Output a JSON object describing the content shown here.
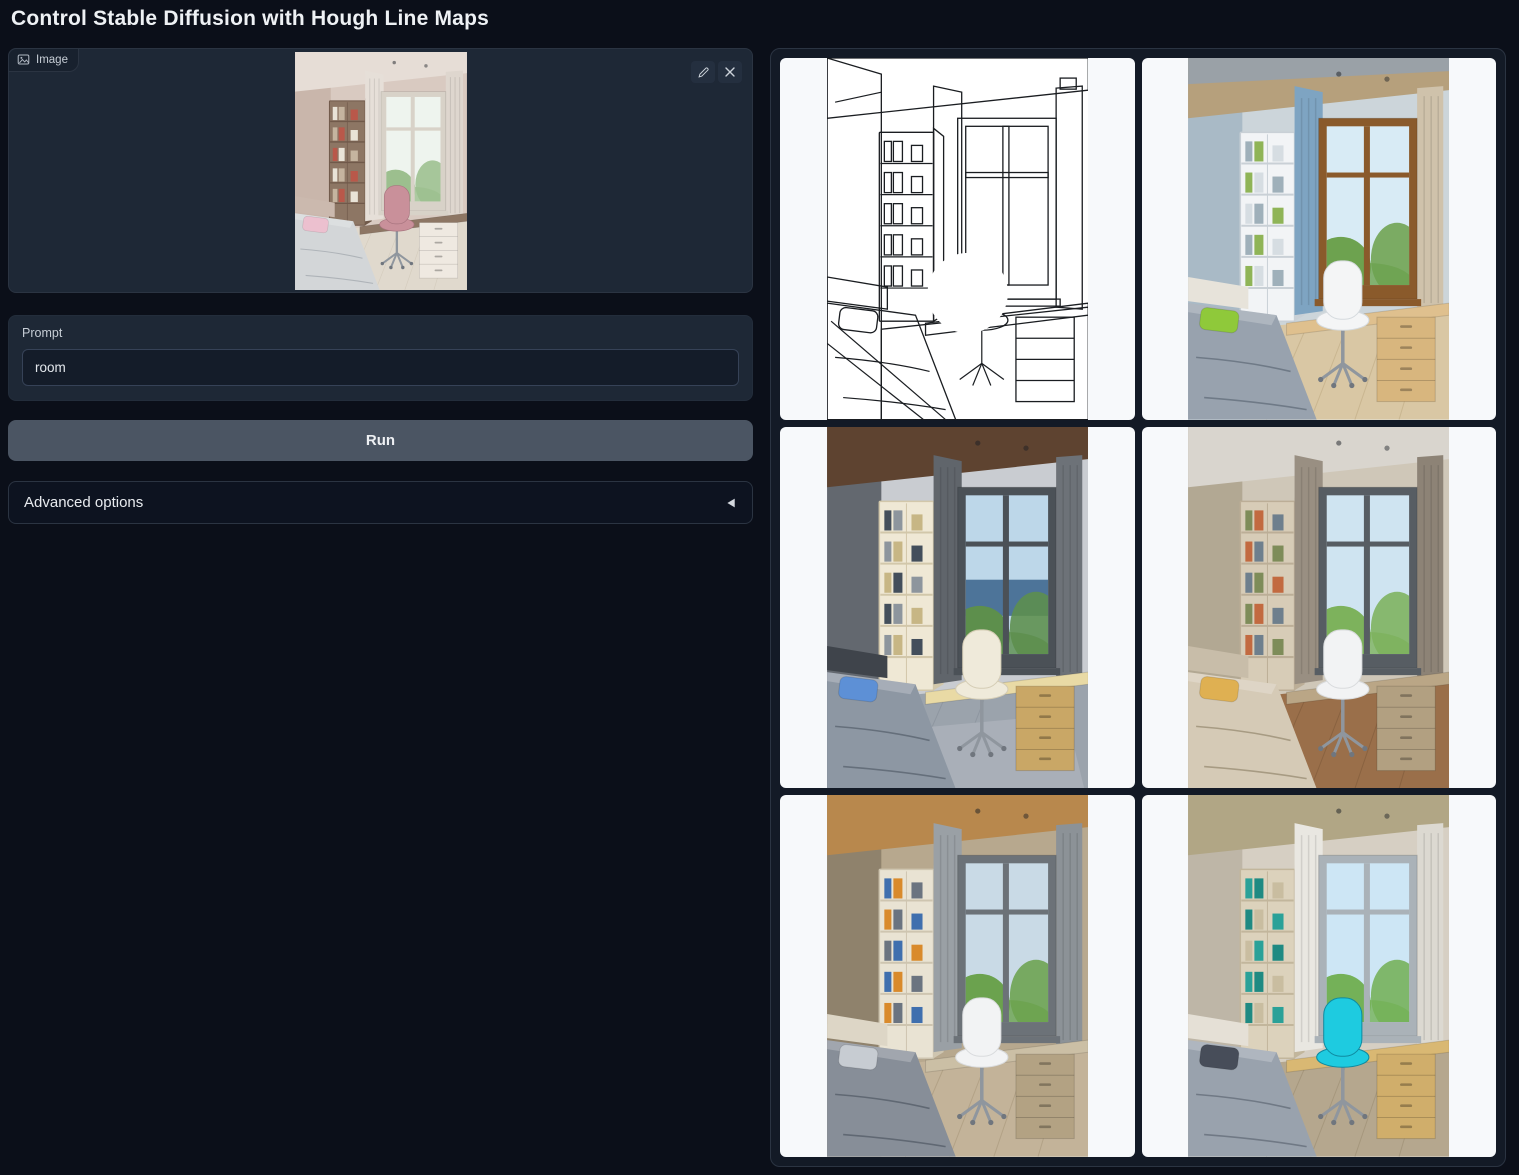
{
  "app": {
    "title": "Control Stable Diffusion with Hough Line Maps"
  },
  "theme": {
    "page_bg": "#0b0f19",
    "block_bg": "#1e2836",
    "block_border": "#2b3442",
    "input_bg": "#141c29",
    "input_border": "#364257",
    "button_bg": "#4b5563",
    "button_text": "#eef0f3",
    "accordion_bg": "#0d1320",
    "gallery_bg": "#131a26",
    "card_bg": "#f7f9fb",
    "text": "#eef1f4",
    "muted_text": "#c6cdd5"
  },
  "image_input": {
    "label": "Image",
    "image": {
      "name": "uploaded-room-photo",
      "type": "room",
      "palette": {
        "wall": "#d9cac1",
        "wallSide": "#c9b6ab",
        "ceiling": "#e6ddd6",
        "band": null,
        "curtainL": "#e6dfd8",
        "curtainR": "#ded6ce",
        "shelf": "#8d7664",
        "shelfLine": "#70594a",
        "books": [
          "#e9e3d7",
          "#c5b49f",
          "#b9584a"
        ],
        "winFrame": "#d8d2c8",
        "sky": "#eef4ee",
        "sea": null,
        "tree": "#9cbf8e",
        "desk": "#8d7664",
        "drawer": "#efe9e1",
        "chair": "#c9909a",
        "chairEdge": "#a8747f",
        "bed": "#d3d6d8",
        "bedLine": "#aeb3b8",
        "pillow": "#ecc0cf",
        "headboard": "#cbb9ae",
        "floor": "#e0d9cd",
        "floorLine": "#cdc4b4",
        "rug": null
      }
    }
  },
  "prompt": {
    "label": "Prompt",
    "value": "room"
  },
  "actions": {
    "run_label": "Run"
  },
  "advanced": {
    "label": "Advanced options"
  },
  "gallery": {
    "items": [
      {
        "name": "hough-line-map",
        "type": "lineart",
        "palette": null
      },
      {
        "name": "generated-room-1",
        "type": "room",
        "palette": {
          "wall": "#ccd5da",
          "wallSide": "#a9bac6",
          "ceiling": "#b6a07c",
          "band": "#9aa1a7",
          "curtainL": "#7ea4c2",
          "curtainR": "#cfc2ab",
          "shelf": "#f2f4f6",
          "shelfLine": "#c9d0d6",
          "books": [
            "#9fb0ba",
            "#8fb457",
            "#d6dde2"
          ],
          "winFrame": "#8a5a2b",
          "sky": "#d8ebf5",
          "sea": null,
          "tree": "#6da24f",
          "desk": "#dfc08e",
          "drawer": "#d8b67e",
          "chair": "#f4f5f6",
          "chairEdge": "#d5dade",
          "bed": "#98a2ae",
          "bedLine": "#6f7a87",
          "pillow": "#8fc93a",
          "headboard": "#e7e3da",
          "floor": "#d9c7a4",
          "floorLine": "#c0ab84",
          "rug": null
        }
      },
      {
        "name": "generated-room-2",
        "type": "room",
        "palette": {
          "wall": "#c9ccd1",
          "wallSide": "#63686f",
          "ceiling": "#5e4330",
          "band": null,
          "curtainL": "#60656b",
          "curtainR": "#6d7278",
          "shelf": "#efe8d5",
          "shelfLine": "#d2c7aa",
          "books": [
            "#434e5b",
            "#8d959d",
            "#c7b685"
          ],
          "winFrame": "#4b5157",
          "sky": "#bdd7e9",
          "sea": "#4d7499",
          "tree": "#5d8f4c",
          "desk": "#e9daa5",
          "drawer": "#c9a766",
          "chair": "#efeada",
          "chairEdge": "#d5cdb5",
          "bed": "#8d97a3",
          "bedLine": "#656f7b",
          "pillow": "#5d90d6",
          "headboard": "#3f444b",
          "floor": "#9ba3ac",
          "floorLine": "#878f99",
          "rug": "#a9afb8"
        }
      },
      {
        "name": "generated-room-3",
        "type": "room",
        "palette": {
          "wall": "#cfc7b8",
          "wallSide": "#b2a893",
          "ceiling": "#d9d5ce",
          "band": null,
          "curtainL": "#998f82",
          "curtainR": "#8d8376",
          "shelf": "#d7ccb7",
          "shelfLine": "#bcae97",
          "books": [
            "#7e8c59",
            "#c26a40",
            "#6e7f8d"
          ],
          "winFrame": "#575d63",
          "sky": "#cfe4f1",
          "sea": null,
          "tree": "#7db25c",
          "desk": "#baa686",
          "drawer": "#b2a081",
          "chair": "#f2f3f4",
          "chairEdge": "#d9dbdd",
          "bed": "#d5cab6",
          "bedLine": "#a79b83",
          "pillow": "#dfb052",
          "headboard": "#c8bda9",
          "floor": "#9a6f4a",
          "floorLine": "#7f5a3a",
          "rug": null
        }
      },
      {
        "name": "generated-room-4",
        "type": "room",
        "palette": {
          "wall": "#b7a88e",
          "wallSide": "#8f826c",
          "ceiling": "#b8884d",
          "band": null,
          "curtainL": "#9aa0a5",
          "curtainR": "#8c9297",
          "shelf": "#e9e3d3",
          "shelfLine": "#cec5b0",
          "books": [
            "#3f6fae",
            "#d98a2b",
            "#6b7480"
          ],
          "winFrame": "#6c7278",
          "sky": "#c9dae6",
          "sea": null,
          "tree": "#6ba24e",
          "desk": "#cbbfa5",
          "drawer": "#b3a283",
          "chair": "#f2f3f4",
          "chairEdge": "#d9dbdd",
          "bed": "#878e98",
          "bedLine": "#606873",
          "pillow": "#c7ccd2",
          "headboard": "#ddd6c6",
          "floor": "#c3b399",
          "floorLine": "#a8977b",
          "rug": null
        }
      },
      {
        "name": "generated-room-5",
        "type": "room",
        "palette": {
          "wall": "#d6cfc3",
          "wallSide": "#beb6a7",
          "ceiling": "#b1a685",
          "band": null,
          "curtainL": "#e9e7e1",
          "curtainR": "#dcd9d1",
          "shelf": "#dcd2bc",
          "shelfLine": "#c2b69c",
          "books": [
            "#2aa198",
            "#1f8a82",
            "#c9bda0"
          ],
          "winFrame": "#aab2b8",
          "sky": "#cde6f5",
          "sea": null,
          "tree": "#74b158",
          "desk": "#d9b873",
          "drawer": "#d0ae6b",
          "chair": "#1ecbe0",
          "chairEdge": "#0f8aa0",
          "bed": "#99a2ad",
          "bedLine": "#707985",
          "pillow": "#474d59",
          "headboard": "#e5e0d6",
          "floor": "#b5a78e",
          "floorLine": "#9c8d72",
          "rug": null
        }
      }
    ]
  }
}
